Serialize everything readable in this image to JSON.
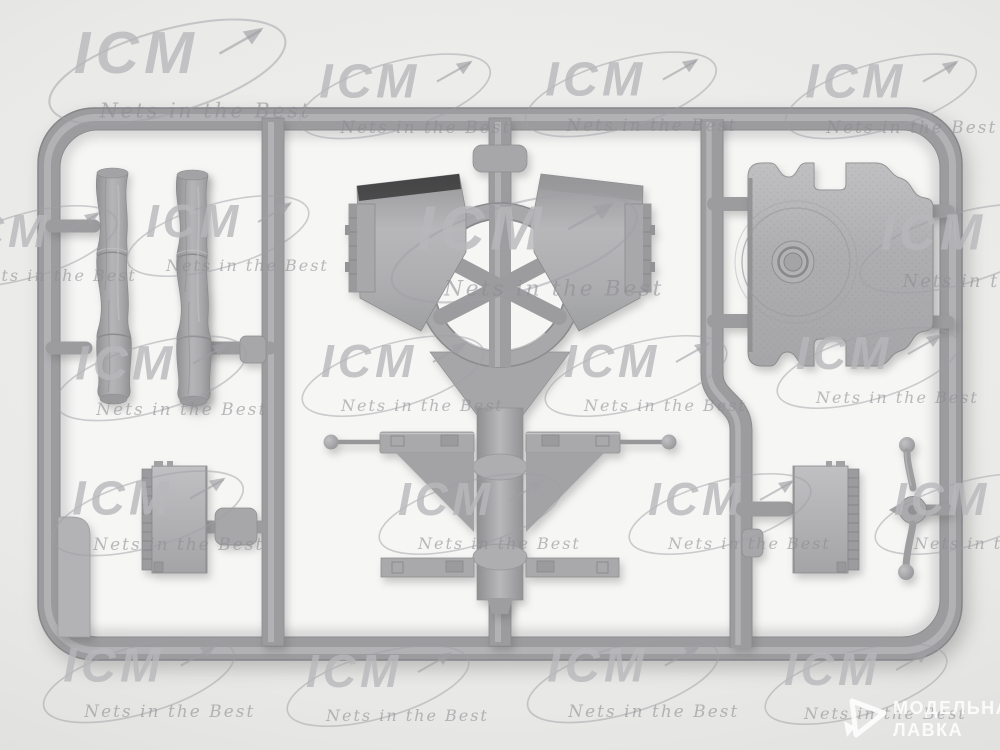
{
  "photo": {
    "description": "Gray plastic model-kit sprue with parts, photographed on a light gray background"
  },
  "watermarks": {
    "icm": {
      "logo_text": "ICM",
      "slogan_text": "Nets in the Best",
      "logo_color": "#b8b8bb",
      "positions": [
        {
          "x": 40,
          "y": 12,
          "s": 1.3
        },
        {
          "x": 292,
          "y": 48,
          "s": 1.05
        },
        {
          "x": 518,
          "y": 46,
          "s": 1.05
        },
        {
          "x": 778,
          "y": 48,
          "s": 1.05
        },
        {
          "x": -72,
          "y": 200,
          "s": 1.0
        },
        {
          "x": 120,
          "y": 190,
          "s": 1.0
        },
        {
          "x": 382,
          "y": 186,
          "s": 1.35
        },
        {
          "x": 852,
          "y": 198,
          "s": 1.1
        },
        {
          "x": 48,
          "y": 330,
          "s": 1.05
        },
        {
          "x": 295,
          "y": 330,
          "s": 1.0
        },
        {
          "x": 538,
          "y": 330,
          "s": 1.0
        },
        {
          "x": 770,
          "y": 322,
          "s": 1.0
        },
        {
          "x": 45,
          "y": 465,
          "s": 1.05
        },
        {
          "x": 372,
          "y": 468,
          "s": 1.0
        },
        {
          "x": 622,
          "y": 468,
          "s": 1.0
        },
        {
          "x": 868,
          "y": 468,
          "s": 1.0
        },
        {
          "x": 36,
          "y": 632,
          "s": 1.05
        },
        {
          "x": 280,
          "y": 640,
          "s": 1.0
        },
        {
          "x": 520,
          "y": 632,
          "s": 1.05
        },
        {
          "x": 758,
          "y": 638,
          "s": 1.0
        }
      ]
    },
    "shop": {
      "line1": "МОДЕЛЬНАЯ",
      "line2": "ЛАВКА",
      "color": "#ffffff"
    }
  },
  "sprue": {
    "plastic_color": "#a8a8aa",
    "rail_color": "#9c9c9e",
    "interior_color": "#f6f6f5",
    "background_color": "#e9e9e7"
  }
}
